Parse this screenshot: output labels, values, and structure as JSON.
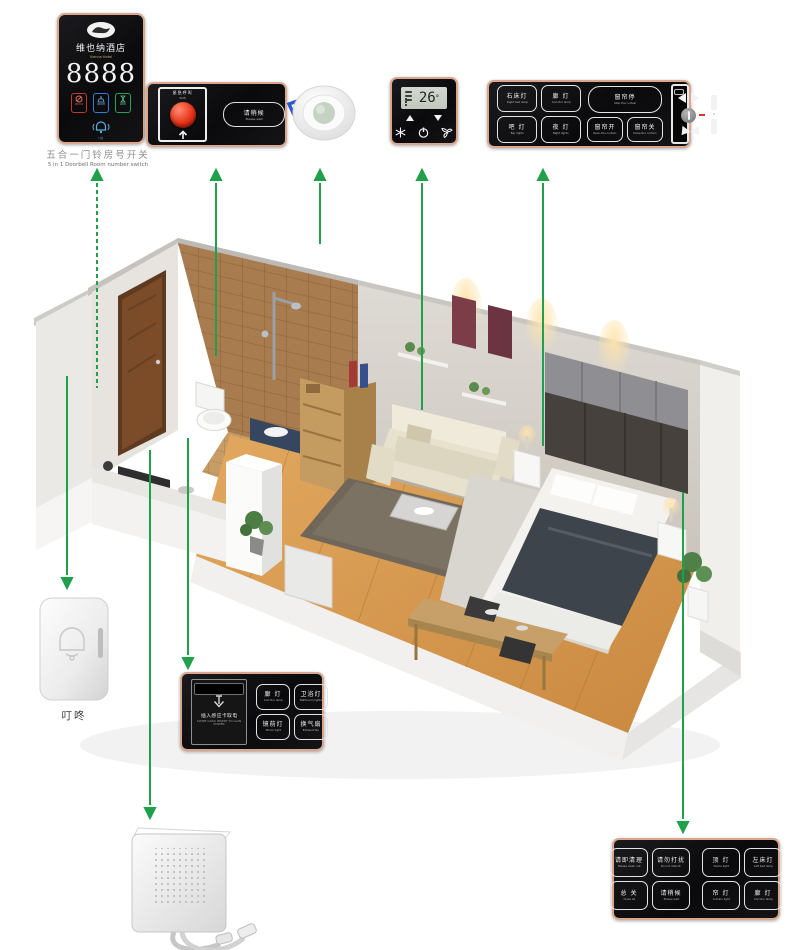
{
  "colors": {
    "arrow_green": "#21a04b",
    "panel_background": "#0b0b0d",
    "panel_border_rosegold": "#d9a78e",
    "indicator_red": "#c0392b",
    "indicator_blue": "#2e7fd0",
    "indicator_green": "#27a356"
  },
  "room_number_panel": {
    "hotel_cn": "维也纳酒店",
    "hotel_en": "Vienna Hotel",
    "room_number": "8888",
    "indicators": [
      {
        "label": "请勿打扰"
      },
      {
        "label": "请即清理"
      },
      {
        "label": "请稍候"
      }
    ],
    "bell_label": "门铃",
    "caption_cn": "五合一门铃房号开关",
    "caption_en": "5 in 1 Doorbell Room number switch"
  },
  "sos_panel": {
    "sos_cn": "紧急呼叫",
    "sos_en": "SOS",
    "wait_cn": "请稍候",
    "wait_en": "Please wait"
  },
  "thermostat": {
    "temperature": "26",
    "unit": "°"
  },
  "bedside_panel_right": {
    "light_buttons": [
      {
        "cn": "右床灯",
        "en": "Right bed lamp"
      },
      {
        "cn": "廊 灯",
        "en": "Corridor lamp"
      },
      {
        "cn": "吧 灯",
        "en": "Bar lights"
      },
      {
        "cn": "夜 灯",
        "en": "Night lights"
      }
    ],
    "curtain_stop_cn": "窗帘停",
    "curtain_stop_en": "Stop the curtain",
    "curtain_open_cn": "窗帘开",
    "curtain_open_en": "Open the curtain",
    "curtain_close_cn": "窗帘关",
    "curtain_close_en": "Close the curtain"
  },
  "doorbell_chime": {
    "label": "叮咚"
  },
  "card_panel": {
    "insert_cn": "插入感应卡取电",
    "insert_en": "SWIPE CARD INSERT TO GAIN POWER",
    "buttons": [
      {
        "cn": "廊 灯",
        "en": "Corridor lamp"
      },
      {
        "cn": "卫浴灯",
        "en": "Bathroom lights"
      },
      {
        "cn": "镜前灯",
        "en": "Mirror light"
      },
      {
        "cn": "换气扇",
        "en": "Exhaust fan"
      }
    ]
  },
  "master_panel": {
    "service_buttons": [
      {
        "cn": "请即清理",
        "en": "Please clean out"
      },
      {
        "cn": "请勿打扰",
        "en": "Do not disturb"
      },
      {
        "cn": "总 关",
        "en": "Close all"
      },
      {
        "cn": "请稍候",
        "en": "Please wait"
      }
    ],
    "light_buttons": [
      {
        "cn": "顶 灯",
        "en": "Dome light"
      },
      {
        "cn": "左床灯",
        "en": "Left bed lamp"
      },
      {
        "cn": "帘 灯",
        "en": "Curtain light"
      },
      {
        "cn": "廊 灯",
        "en": "Corridor lamp"
      }
    ]
  }
}
